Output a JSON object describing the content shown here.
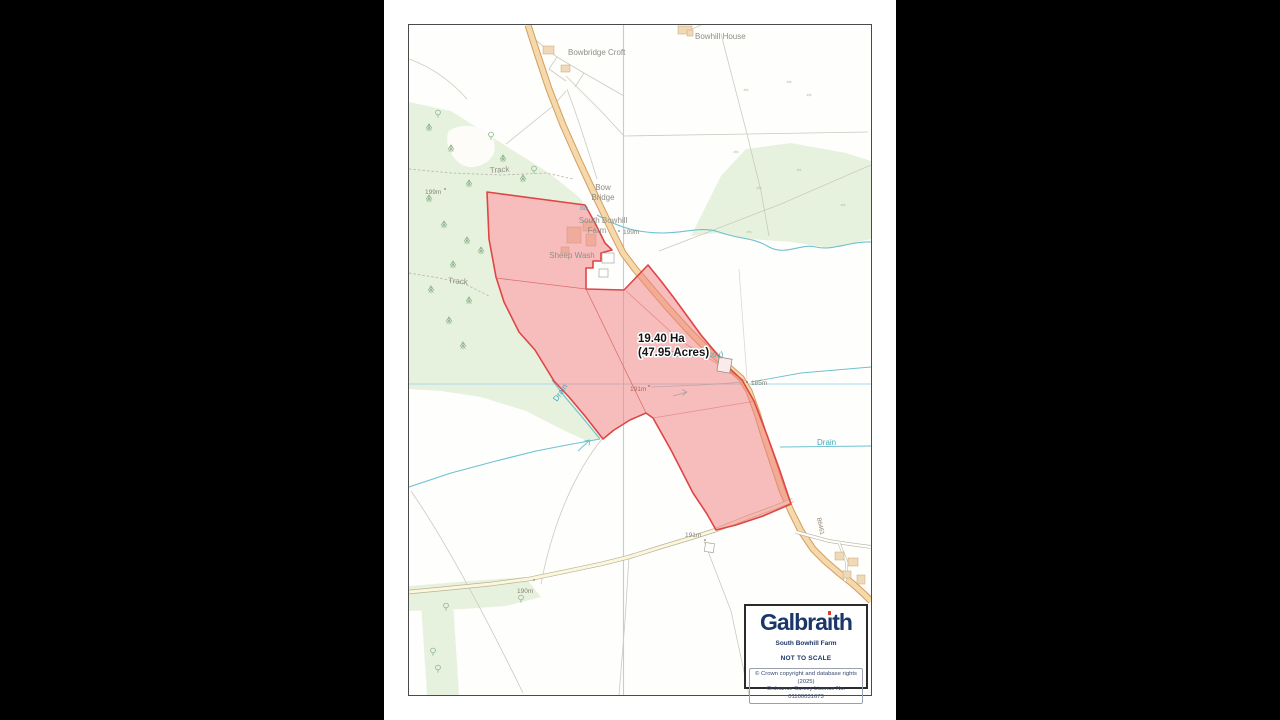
{
  "map": {
    "labels": {
      "bowhill_house": "Bowhill House",
      "bowbridge_croft": "Bowbridge Croft",
      "track_upper": "Track",
      "track_lower": "Track",
      "bow_bridge_line1": "Bow",
      "bow_bridge_line2": "Bridge",
      "farm_line1": "South Bowhill",
      "farm_line2": "Farm",
      "sheep_wash": "Sheep Wash",
      "issues": "Iss",
      "drain_west": "Drain",
      "drain_east": "Drain",
      "reservoir": "Reservoir (cov)",
      "road_number": "B6461",
      "spot_height_199_wood": "199m",
      "spot_height_199_farm": "199m",
      "spot_height_191_field": "191m",
      "spot_height_185": "185m",
      "spot_height_191_track": "191m",
      "spot_height_190": "190m"
    },
    "area_label": {
      "line1": "19.40 Ha",
      "line2": "(47.95 Acres)"
    },
    "colors": {
      "parcel_fill": "#f08080",
      "parcel_stroke": "#e04545",
      "water": "#6fc2cf",
      "woodland": "#e7f2de",
      "road_fill": "#f4d9ac",
      "road_casing": "#d79c5e",
      "grid": "#a8d8e8"
    }
  },
  "legend": {
    "brand": "Galbraith",
    "brand_prefix": "Galbra",
    "brand_i": "ı",
    "brand_suffix": "th",
    "brand_color": "#1b3668",
    "accent_color": "#e2372e",
    "property_name": "South Bowhill Farm",
    "scale_note": "NOT TO SCALE",
    "copyright_line1": "© Crown copyright and database rights (2025)",
    "copyright_line2": "Ordnance Survey Licence No. 01100031673"
  }
}
